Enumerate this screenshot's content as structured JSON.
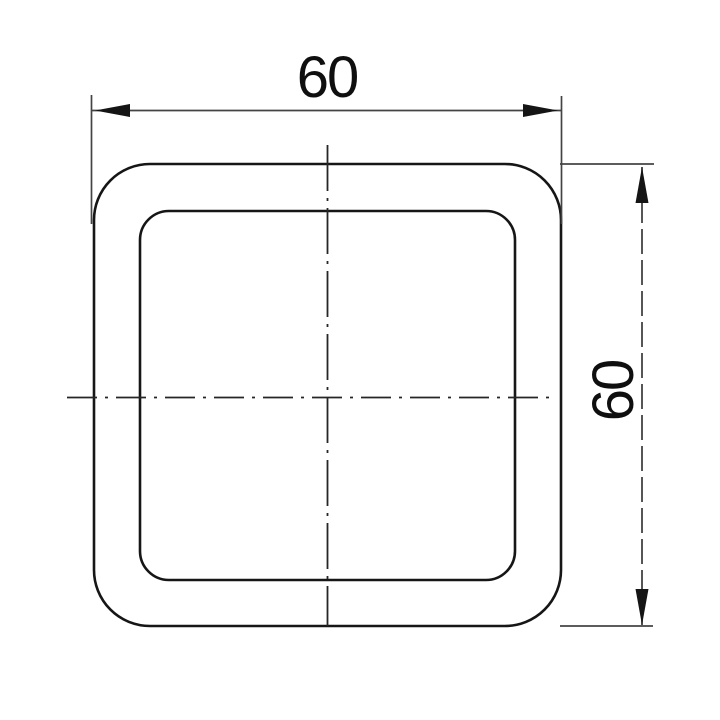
{
  "drawing": {
    "background": "#ffffff",
    "object_line_color": "#161616",
    "dim_line_color": "#444444",
    "centerline_color": "#262626",
    "arrow_color": "#151515",
    "text_color": "#0f0f0f",
    "width_dimension": {
      "value": "60"
    },
    "height_dimension": {
      "value": "60"
    }
  }
}
